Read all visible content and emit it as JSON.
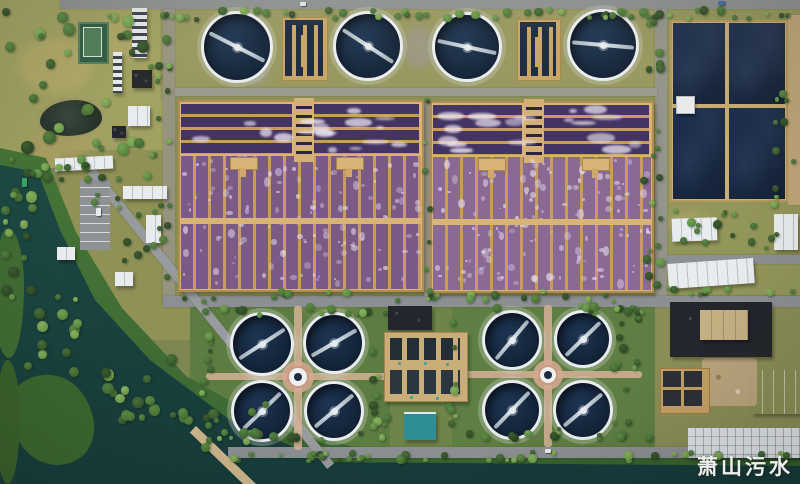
{
  "watermark": {
    "text": "萧山污水"
  },
  "palette": {
    "ground": "#7e8752",
    "road": "#8d9092",
    "dirt": "#c0a678",
    "water": "#1b4540",
    "bank": "#3e6a33",
    "tank_water": "#16273f",
    "tank_rim": "#eaedf0",
    "bridge": "#c9d3da",
    "pond_water": "#1b2b48",
    "pond_wall": "#c9ad72",
    "aeration_dark": "#453463",
    "divider": "#c79c5e",
    "walkway": "#d8b477",
    "white_roof": "#e9ecee",
    "dark_roof": "#23262c",
    "blue_roof": "#a5bccf",
    "teal_roof": "#2e8d95",
    "tan_roof": "#c5b182",
    "facility_tan": "#c9ae7a",
    "path_pink": "#d6b296",
    "hub_ring": "#d8a893"
  },
  "scene": {
    "grass": [
      {
        "x": 0,
        "y": 0,
        "w": 163,
        "h": 168,
        "c": "#a1a162"
      },
      {
        "x": 160,
        "y": 9,
        "w": 505,
        "h": 92,
        "c": "#97975f"
      },
      {
        "x": 175,
        "y": 95,
        "w": 485,
        "h": 206,
        "c": "#8e8f58"
      },
      {
        "x": 60,
        "y": 150,
        "w": 130,
        "h": 190,
        "c": "#8f9157"
      },
      {
        "x": 190,
        "y": 300,
        "w": 212,
        "h": 156,
        "c": "#5d7c41"
      },
      {
        "x": 445,
        "y": 300,
        "w": 217,
        "h": 154,
        "c": "#5f7e43"
      },
      {
        "x": 667,
        "y": 9,
        "w": 133,
        "h": 292,
        "c": "#93965a"
      },
      {
        "x": 390,
        "y": 300,
        "w": 62,
        "h": 152,
        "c": "#6e8448"
      },
      {
        "x": 655,
        "y": 295,
        "w": 145,
        "h": 165,
        "c": "#8a8d55"
      }
    ],
    "dapples": [
      {
        "x": 18,
        "y": 38,
        "w": 75,
        "h": 55,
        "c": "#b2aa69"
      },
      {
        "x": 92,
        "y": 18,
        "w": 55,
        "h": 42,
        "c": "#aea768"
      },
      {
        "x": 28,
        "y": 128,
        "w": 62,
        "h": 32,
        "c": "#a89d62"
      },
      {
        "x": 404,
        "y": 26,
        "w": 30,
        "h": 42,
        "c": "#9c9789"
      },
      {
        "x": 240,
        "y": 62,
        "w": 28,
        "h": 22,
        "c": "#a39d8f"
      },
      {
        "x": 668,
        "y": 210,
        "w": 40,
        "h": 26,
        "c": "#a7a06a"
      },
      {
        "x": 300,
        "y": 298,
        "w": 60,
        "h": 20,
        "c": "#6f8a4a"
      },
      {
        "x": 60,
        "y": 300,
        "w": 50,
        "h": 40,
        "c": "#9aa05e"
      }
    ],
    "bank_poly": [
      [
        0,
        148
      ],
      [
        46,
        158
      ],
      [
        76,
        232
      ],
      [
        122,
        308
      ],
      [
        186,
        376
      ],
      [
        282,
        430
      ],
      [
        368,
        450
      ],
      [
        800,
        449
      ],
      [
        800,
        484
      ],
      [
        0,
        484
      ]
    ],
    "water_poly": [
      [
        0,
        165
      ],
      [
        38,
        172
      ],
      [
        60,
        230
      ],
      [
        95,
        300
      ],
      [
        150,
        360
      ],
      [
        230,
        420
      ],
      [
        330,
        462
      ],
      [
        800,
        466
      ],
      [
        800,
        484
      ],
      [
        0,
        484
      ]
    ],
    "islands": [
      {
        "x": 12,
        "y": 372,
        "w": 80,
        "h": 95,
        "rot": -38,
        "c": "#3c682e"
      },
      {
        "x": -6,
        "y": 228,
        "w": 30,
        "h": 130,
        "rot": 0,
        "c": "#426d33"
      },
      {
        "x": -4,
        "y": 360,
        "w": 24,
        "h": 124,
        "rot": 0,
        "c": "#3c632c"
      }
    ],
    "roads": [
      {
        "x": 60,
        "y": 0,
        "w": 740,
        "h": 9,
        "c": "#8d9092"
      },
      {
        "x": 163,
        "y": 9,
        "w": 12,
        "h": 292,
        "c": "#96937f"
      },
      {
        "x": 655,
        "y": 9,
        "w": 12,
        "h": 290,
        "c": "#95948a"
      },
      {
        "x": 163,
        "y": 296,
        "w": 637,
        "h": 11,
        "c": "#8d9092"
      },
      {
        "x": 175,
        "y": 88,
        "w": 482,
        "h": 8,
        "c": "#9a9a8e"
      },
      {
        "x": 424,
        "y": 100,
        "w": 7,
        "h": 196,
        "c": "#9b9782"
      },
      {
        "x": 667,
        "y": 255,
        "w": 133,
        "h": 9,
        "c": "#8d9092"
      },
      {
        "x": 228,
        "y": 447,
        "w": 572,
        "h": 11,
        "c": "#8d9092"
      },
      {
        "x": 788,
        "y": 15,
        "w": 12,
        "h": 190,
        "c": "#c0a678"
      },
      {
        "x": 95,
        "y": 168,
        "w": 380,
        "h": 9,
        "rot": 51,
        "c": "#989b9d"
      },
      {
        "x": 196,
        "y": 426,
        "w": 86,
        "h": 9,
        "rot": 44,
        "c": "#cdb68c"
      }
    ],
    "paths": [
      {
        "x": 206,
        "y": 373,
        "w": 186,
        "h": 7
      },
      {
        "x": 294,
        "y": 306,
        "w": 8,
        "h": 144
      },
      {
        "x": 458,
        "y": 371,
        "w": 184,
        "h": 7
      },
      {
        "x": 544,
        "y": 305,
        "w": 8,
        "h": 142
      }
    ],
    "clarifiers": [
      {
        "cx": 237,
        "cy": 47,
        "r": 36,
        "deg": 27
      },
      {
        "cx": 368,
        "cy": 46,
        "r": 35,
        "deg": 33
      },
      {
        "cx": 467,
        "cy": 47,
        "r": 35,
        "deg": 12
      },
      {
        "cx": 603,
        "cy": 45,
        "r": 36,
        "deg": 5
      },
      {
        "cx": 262,
        "cy": 344,
        "r": 32,
        "deg": -33
      },
      {
        "cx": 334,
        "cy": 343,
        "r": 31,
        "deg": -30
      },
      {
        "cx": 262,
        "cy": 411,
        "r": 31,
        "deg": -44
      },
      {
        "cx": 334,
        "cy": 411,
        "r": 30,
        "deg": -40
      },
      {
        "cx": 512,
        "cy": 340,
        "r": 30,
        "deg": -50
      },
      {
        "cx": 583,
        "cy": 339,
        "r": 29,
        "deg": -44
      },
      {
        "cx": 512,
        "cy": 410,
        "r": 30,
        "deg": -46
      },
      {
        "cx": 583,
        "cy": 410,
        "r": 30,
        "deg": -40
      }
    ],
    "hubs": [
      {
        "cx": 298,
        "cy": 377,
        "r": 11
      },
      {
        "cx": 548,
        "cy": 375,
        "r": 10
      }
    ],
    "dist_structures": [
      {
        "x": 282,
        "y": 17,
        "w": 44,
        "h": 62
      },
      {
        "x": 517,
        "y": 19,
        "w": 42,
        "h": 60
      }
    ],
    "aeration": [
      {
        "x": 178,
        "y": 100,
        "w": 246,
        "h": 192,
        "topH": 56,
        "towerX": 294,
        "towerW": 16,
        "towerH": 60,
        "pads": [
          [
            230,
            157
          ],
          [
            336,
            157
          ]
        ],
        "walkY": 218,
        "seed": 11,
        "lane": "#7c5a86",
        "foam": "#cdbfd6"
      },
      {
        "x": 430,
        "y": 101,
        "w": 224,
        "h": 192,
        "topH": 56,
        "towerX": 524,
        "towerW": 16,
        "towerH": 60,
        "pads": [
          [
            478,
            158
          ],
          [
            582,
            158
          ]
        ],
        "walkY": 219,
        "seed": 23,
        "lane": "#8a6a92",
        "foam": "#d8cce0"
      }
    ],
    "pond_grid": {
      "x": 670,
      "y": 20,
      "w": 118,
      "h": 182,
      "vx": 727,
      "hy": 106,
      "hut": {
        "x": 676,
        "y": 96,
        "w": 17,
        "h": 16
      }
    },
    "park": {
      "tennis": {
        "x": 78,
        "y": 22,
        "w": 27,
        "h": 38
      },
      "pond": {
        "x": 40,
        "y": 100,
        "w": 62,
        "h": 36
      }
    },
    "buildings": [
      {
        "k": "dirt",
        "x": 702,
        "y": 358,
        "w": 55,
        "h": 48
      },
      {
        "k": "white",
        "x": 672,
        "y": 218,
        "w": 45,
        "h": 23,
        "rot": -2
      },
      {
        "k": "white",
        "x": 668,
        "y": 261,
        "w": 86,
        "h": 25,
        "rot": -4
      },
      {
        "k": "dark",
        "x": 670,
        "y": 302,
        "w": 102,
        "h": 55
      },
      {
        "k": "tan",
        "x": 700,
        "y": 310,
        "w": 48,
        "h": 30
      },
      {
        "k": "white",
        "x": 774,
        "y": 214,
        "w": 24,
        "h": 36
      },
      {
        "k": "tank",
        "x": 660,
        "y": 368,
        "w": 48,
        "h": 44
      },
      {
        "k": "blue",
        "x": 752,
        "y": 370,
        "w": 48,
        "h": 44
      },
      {
        "k": "whitegrid",
        "x": 688,
        "y": 428,
        "w": 112,
        "h": 30
      },
      {
        "k": "dark",
        "x": 388,
        "y": 306,
        "w": 44,
        "h": 24
      },
      {
        "k": "facility",
        "x": 384,
        "y": 332,
        "w": 82,
        "h": 68
      },
      {
        "k": "teal",
        "x": 404,
        "y": 412,
        "w": 32,
        "h": 26
      },
      {
        "k": "white",
        "x": 55,
        "y": 157,
        "w": 58,
        "h": 13,
        "rot": -3
      },
      {
        "k": "white",
        "x": 123,
        "y": 186,
        "w": 44,
        "h": 13
      },
      {
        "k": "white",
        "x": 146,
        "y": 215,
        "w": 15,
        "h": 28
      },
      {
        "k": "white",
        "x": 57,
        "y": 247,
        "w": 18,
        "h": 13
      },
      {
        "k": "white",
        "x": 115,
        "y": 272,
        "w": 18,
        "h": 14
      },
      {
        "k": "slab",
        "x": 132,
        "y": 8,
        "w": 15,
        "h": 50
      },
      {
        "k": "slab",
        "x": 113,
        "y": 52,
        "w": 9,
        "h": 41
      },
      {
        "k": "dark",
        "x": 132,
        "y": 70,
        "w": 20,
        "h": 18
      },
      {
        "k": "white",
        "x": 128,
        "y": 106,
        "w": 22,
        "h": 20
      },
      {
        "k": "dark",
        "x": 112,
        "y": 126,
        "w": 14,
        "h": 12
      },
      {
        "k": "parking",
        "x": 80,
        "y": 180,
        "w": 30,
        "h": 70
      },
      {
        "k": "pondhut",
        "x": 676,
        "y": 96,
        "w": 17,
        "h": 16
      }
    ],
    "vehicles": [
      {
        "x": 300,
        "y": 2,
        "w": 6,
        "h": 4,
        "c": "#dfe3e6"
      },
      {
        "x": 545,
        "y": 449,
        "w": 6,
        "h": 4,
        "c": "#e8ebee"
      },
      {
        "x": 718,
        "y": 1,
        "w": 7,
        "h": 4,
        "c": "#3f6cb0"
      },
      {
        "x": 96,
        "y": 208,
        "w": 5,
        "h": 8,
        "c": "#e8ebee"
      },
      {
        "x": 22,
        "y": 178,
        "w": 5,
        "h": 9,
        "c": "#3aa566"
      }
    ],
    "tree_bands": [
      {
        "x": 60,
        "y": 6,
        "w": 740,
        "h": 16,
        "n": 55,
        "min": 4,
        "max": 9,
        "seed": 1
      },
      {
        "x": 0,
        "y": 8,
        "w": 150,
        "h": 150,
        "n": 26,
        "min": 6,
        "max": 13,
        "seed": 2
      },
      {
        "x": 148,
        "y": 18,
        "w": 26,
        "h": 275,
        "n": 20,
        "min": 4,
        "max": 9,
        "seed": 3
      },
      {
        "x": 640,
        "y": 14,
        "w": 26,
        "h": 280,
        "n": 20,
        "min": 4,
        "max": 9,
        "seed": 4
      },
      {
        "x": 170,
        "y": 288,
        "w": 480,
        "h": 16,
        "n": 26,
        "min": 4,
        "max": 9,
        "seed": 5
      },
      {
        "x": 200,
        "y": 303,
        "w": 190,
        "h": 16,
        "n": 14,
        "min": 4,
        "max": 9,
        "seed": 6
      },
      {
        "x": 198,
        "y": 428,
        "w": 195,
        "h": 16,
        "n": 14,
        "min": 4,
        "max": 9,
        "seed": 7
      },
      {
        "x": 198,
        "y": 318,
        "w": 18,
        "h": 112,
        "n": 9,
        "min": 4,
        "max": 9,
        "seed": 8
      },
      {
        "x": 368,
        "y": 318,
        "w": 24,
        "h": 112,
        "n": 10,
        "min": 4,
        "max": 9,
        "seed": 9
      },
      {
        "x": 452,
        "y": 302,
        "w": 200,
        "h": 14,
        "n": 14,
        "min": 4,
        "max": 9,
        "seed": 10
      },
      {
        "x": 455,
        "y": 426,
        "w": 200,
        "h": 16,
        "n": 14,
        "min": 4,
        "max": 9,
        "seed": 11
      },
      {
        "x": 444,
        "y": 315,
        "w": 16,
        "h": 112,
        "n": 8,
        "min": 4,
        "max": 9,
        "seed": 12
      },
      {
        "x": 608,
        "y": 315,
        "w": 34,
        "h": 112,
        "n": 12,
        "min": 4,
        "max": 9,
        "seed": 13
      },
      {
        "x": 0,
        "y": 148,
        "w": 110,
        "h": 36,
        "n": 14,
        "min": 5,
        "max": 11,
        "seed": 14
      },
      {
        "x": 0,
        "y": 185,
        "w": 40,
        "h": 120,
        "n": 16,
        "min": 5,
        "max": 12,
        "seed": 15
      },
      {
        "x": 22,
        "y": 290,
        "w": 60,
        "h": 95,
        "n": 14,
        "min": 5,
        "max": 12,
        "seed": 16
      },
      {
        "x": 95,
        "y": 340,
        "w": 95,
        "h": 85,
        "n": 18,
        "min": 5,
        "max": 12,
        "seed": 17
      },
      {
        "x": 175,
        "y": 400,
        "w": 95,
        "h": 60,
        "n": 12,
        "min": 5,
        "max": 11,
        "seed": 18
      },
      {
        "x": 230,
        "y": 450,
        "w": 570,
        "h": 14,
        "n": 42,
        "min": 4,
        "max": 9,
        "seed": 19
      },
      {
        "x": 655,
        "y": 205,
        "w": 140,
        "h": 50,
        "n": 16,
        "min": 4,
        "max": 9,
        "seed": 20
      },
      {
        "x": 658,
        "y": 285,
        "w": 140,
        "h": 14,
        "n": 10,
        "min": 4,
        "max": 8,
        "seed": 21
      },
      {
        "x": 762,
        "y": 80,
        "w": 36,
        "h": 130,
        "n": 10,
        "min": 4,
        "max": 9,
        "seed": 22
      },
      {
        "x": 90,
        "y": 150,
        "w": 80,
        "h": 120,
        "n": 12,
        "min": 4,
        "max": 9,
        "seed": 23
      },
      {
        "x": 420,
        "y": 95,
        "w": 14,
        "h": 200,
        "n": 8,
        "min": 3,
        "max": 7,
        "seed": 24
      }
    ]
  }
}
